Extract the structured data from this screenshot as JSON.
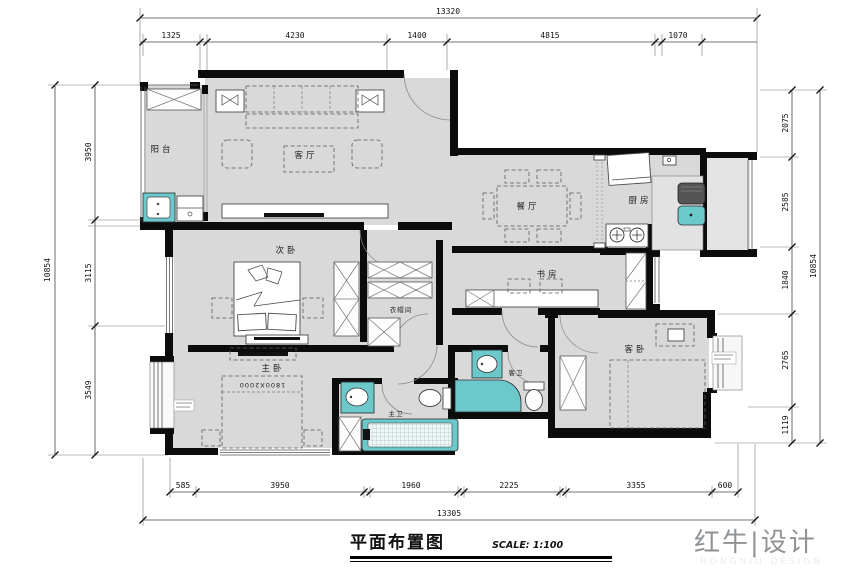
{
  "title_block": {
    "title": "平面布置图",
    "scale": "SCALE: 1:100"
  },
  "logo": {
    "name_cn": "红牛|设计",
    "name_en": "HONGNIU DESIGN"
  },
  "dimensions": {
    "top": {
      "total": "13320",
      "segments": [
        "1325",
        "4230",
        "1400",
        "4815",
        "1070"
      ]
    },
    "bottom": {
      "total": "13305",
      "segments": [
        "585",
        "3950",
        "1960",
        "2225",
        "3355",
        "600"
      ]
    },
    "left": {
      "total": "10854",
      "segments": [
        "3950",
        "3115",
        "3549"
      ]
    },
    "right": {
      "total": "10854",
      "segments": [
        "2075",
        "2585",
        "1840",
        "2765",
        "1119"
      ]
    }
  },
  "rooms": {
    "balcony": "阳台",
    "living": "客厅",
    "dining": "餐厅",
    "kitchen": "厨房",
    "bedroom2": "次卧",
    "study": "书房",
    "cloakroom": "衣帽间",
    "master": "主卧",
    "guest_bath": "客卫",
    "master_bath": "主卫",
    "guest_bedroom": "客卧",
    "master_bed_size": "1800X2000"
  },
  "colors": {
    "fixture": "#6cc9cb",
    "floor": "#d9d9d9",
    "wall": "#0c0c0c"
  }
}
